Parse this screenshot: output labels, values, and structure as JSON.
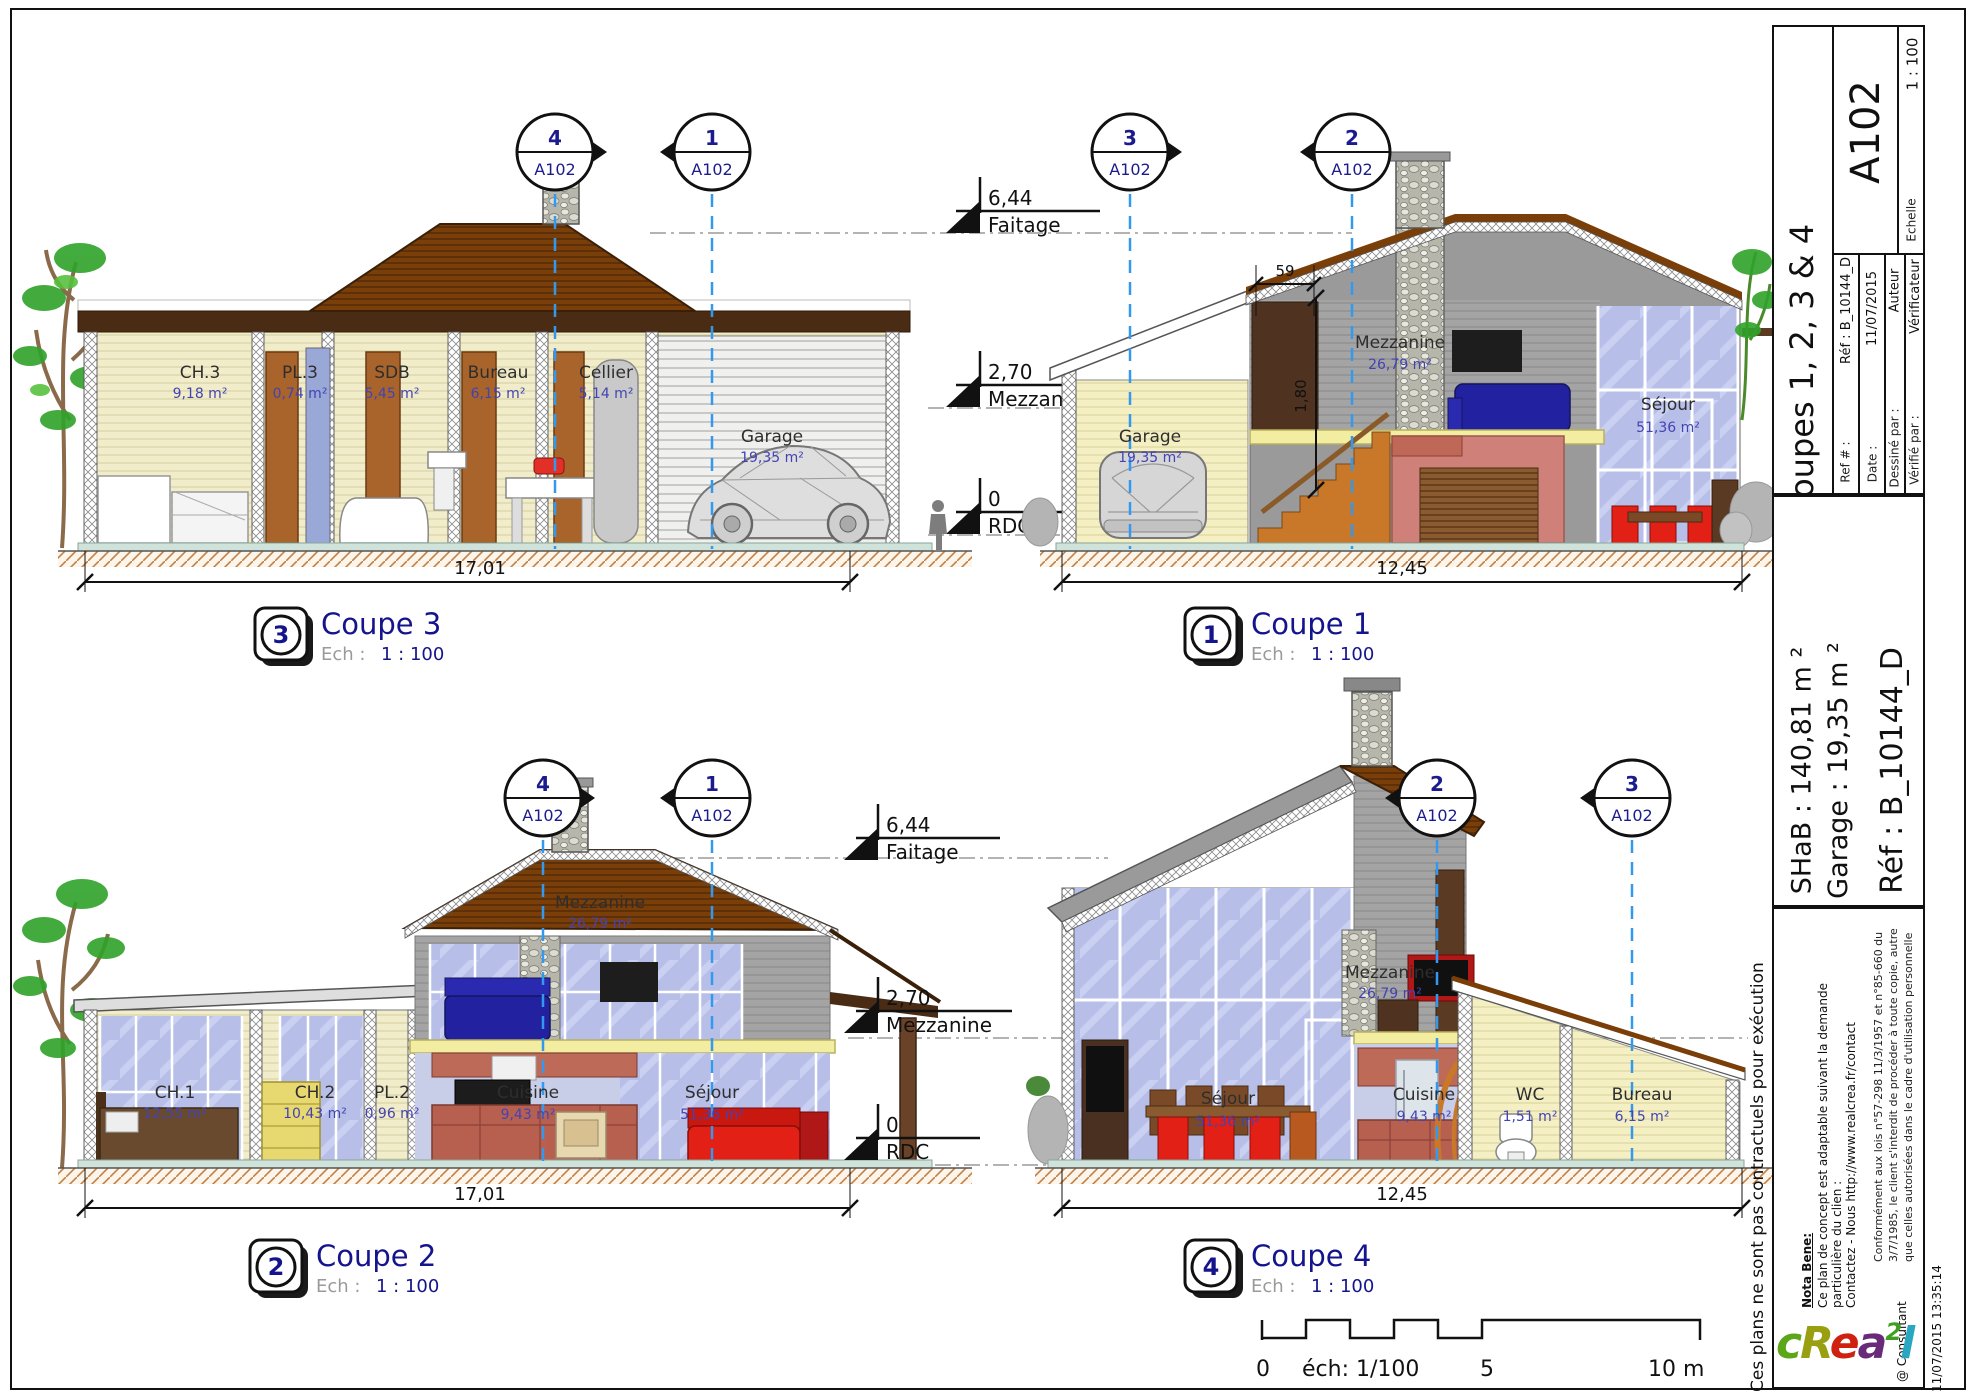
{
  "titleblock": {
    "sheet_number": "A102",
    "sheet_title": "Coupes 1, 2, 3 & 4",
    "scale_value": "1 : 100",
    "scale_label": "Echelle",
    "ref_label": "Ref # :",
    "ref_value": "Réf : B_10144_D",
    "date_label": "Date :",
    "date_value": "11/07/2015",
    "drawn_label": "Dessiné par :",
    "drawn_value": "Auteur",
    "checked_label": "Vérifié par :",
    "checked_value": "Vérificateur",
    "shab": "SHaB : 140,81 m ²",
    "garage": "Garage : 19,35 m ²",
    "ref_big": "Réf : B_10144_D"
  },
  "notes": {
    "margin": "Ces plans ne sont pas contractuels pour exécution",
    "nota_title": "Nota Bene:",
    "nota_1": "Ce plan de concept est adaptable suivant la demande",
    "nota_2": "particulière du clien :",
    "nota_3": "Contactez - Nous http://www.realcrea.fr/contact",
    "legal_1": "Conformément aux lois n°57-298 11/3/1957 et n°85-660 du",
    "legal_2": "3/7/1985, le client s'interdit de procéder à toute copie, autre",
    "legal_3": "que celles autorisées dans le cadre d'utilisation personnelle",
    "consultant": "@ Consultant",
    "timestamp": "11/07/2015 13:35:14"
  },
  "logo": {
    "c": "c",
    "r": "R",
    "e": "e",
    "a": "a",
    "sup": "2",
    "l": "l"
  },
  "levels": {
    "faitage_v": "6,44",
    "faitage_l": "Faitage",
    "mezz_v": "2,70",
    "mezz_l": "Mezzanine",
    "rdc_v": "0",
    "rdc_l": "RDC"
  },
  "scalebar": {
    "zero": "0",
    "ech": "éch: 1/100",
    "five": "5",
    "ten": "10 m"
  },
  "coupe3": {
    "num": "3",
    "title": "Coupe 3",
    "ech_label": "Ech :",
    "ech_value": "1 : 100",
    "dim": "17,01",
    "marker_left": {
      "num": "4",
      "sheet": "A102"
    },
    "marker_right": {
      "num": "1",
      "sheet": "A102"
    },
    "rooms": {
      "ch3": {
        "name": "CH.3",
        "area": "9,18 m²"
      },
      "pl3": {
        "name": "PL.3",
        "area": "0,74 m²"
      },
      "sdb": {
        "name": "SDB",
        "area": "5,45 m²"
      },
      "bureau": {
        "name": "Bureau",
        "area": "6,15 m²"
      },
      "cellier": {
        "name": "Cellier",
        "area": "5,14 m²"
      },
      "garage": {
        "name": "Garage",
        "area": "19,35 m²"
      }
    }
  },
  "coupe1": {
    "num": "1",
    "title": "Coupe 1",
    "ech_label": "Ech :",
    "ech_value": "1 : 100",
    "dim": "12,45",
    "dim_top": "59",
    "dim_height": "1,80",
    "marker_left": {
      "num": "3",
      "sheet": "A102"
    },
    "marker_right": {
      "num": "2",
      "sheet": "A102"
    },
    "rooms": {
      "garage": {
        "name": "Garage",
        "area": "19,35 m²"
      },
      "mezzanine": {
        "name": "Mezzanine",
        "area": "26,79 m²"
      },
      "sejour": {
        "name": "Séjour",
        "area": "51,36 m²"
      }
    }
  },
  "coupe2": {
    "num": "2",
    "title": "Coupe 2",
    "ech_label": "Ech :",
    "ech_value": "1 : 100",
    "dim": "17,01",
    "marker_left": {
      "num": "4",
      "sheet": "A102"
    },
    "marker_right": {
      "num": "1",
      "sheet": "A102"
    },
    "rooms": {
      "ch1": {
        "name": "CH.1",
        "area": "12,55 m²"
      },
      "ch2": {
        "name": "CH.2",
        "area": "10,43 m²"
      },
      "pl2": {
        "name": "PL.2",
        "area": "0,96 m²"
      },
      "cuisine": {
        "name": "Cuisine",
        "area": "9,43 m²"
      },
      "sejour": {
        "name": "Séjour",
        "area": "51,36 m²"
      },
      "mezzanine": {
        "name": "Mezzanine",
        "area": "26,79 m²"
      }
    }
  },
  "coupe4": {
    "num": "4",
    "title": "Coupe 4",
    "ech_label": "Ech :",
    "ech_value": "1 : 100",
    "dim": "12,45",
    "marker_left": {
      "num": "2",
      "sheet": "A102"
    },
    "marker_right": {
      "num": "3",
      "sheet": "A102"
    },
    "rooms": {
      "sejour": {
        "name": "Séjour",
        "area": "51,36 m²"
      },
      "mezzanine": {
        "name": "Mezzanine",
        "area": "26,79 m²"
      },
      "cuisine": {
        "name": "Cuisine",
        "area": "9,43 m²"
      },
      "wc": {
        "name": "WC",
        "area": "1,51 m²"
      },
      "bureau": {
        "name": "Bureau",
        "area": "6,15 m²"
      }
    }
  }
}
